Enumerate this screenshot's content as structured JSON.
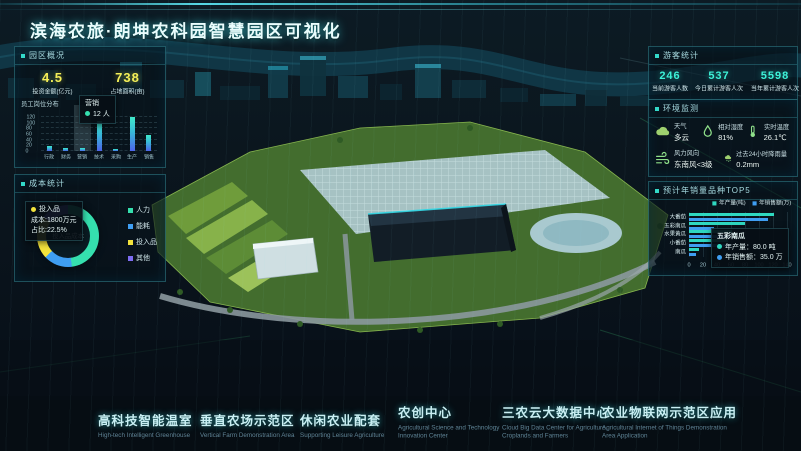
{
  "title": "滨海农旅·朗坤农科园智慧园区可视化",
  "panels": {
    "overview": {
      "header": "园区概况",
      "stats": [
        {
          "value": "4.5",
          "label": "投资金额(亿元)"
        },
        {
          "value": "738",
          "label": "占地面积(亩)"
        }
      ],
      "staff_title": "员工岗位分布",
      "tooltip": {
        "category": "营销",
        "value": "12",
        "unit": "人"
      }
    },
    "cost": {
      "header": "成本统计",
      "center_label": "投入品成本",
      "tooltip": {
        "name": "投入品",
        "line1": "成本:1800万元",
        "line2": "占比:22.5%"
      },
      "legend": [
        {
          "label": "人力",
          "color": "#35dfae"
        },
        {
          "label": "能耗",
          "color": "#3f9ef2"
        },
        {
          "label": "投入品",
          "color": "#f2e23c"
        },
        {
          "label": "其他",
          "color": "#7d6cf2"
        }
      ]
    },
    "visitors": {
      "header": "游客统计",
      "stats": [
        {
          "value": "246",
          "label": "当前游客人数"
        },
        {
          "value": "537",
          "label": "今日累计游客人次"
        },
        {
          "value": "5598",
          "label": "当年累计游客人次"
        }
      ]
    },
    "environment": {
      "header": "环境监测",
      "items": [
        {
          "icon": "cloud-icon",
          "label": "天气",
          "value": "多云"
        },
        {
          "icon": "droplet-icon",
          "label": "相对湿度",
          "value": "81%"
        },
        {
          "icon": "thermometer-icon",
          "label": "实时温度",
          "value": "26.1℃"
        },
        {
          "icon": "wind-icon",
          "label": "风力风向",
          "value": "东南风<3级"
        },
        {
          "icon": "rain-icon",
          "label": "过去24小时降雨量",
          "value": "0.2mm"
        }
      ]
    },
    "sales": {
      "header": "预计年销量品种TOP5",
      "tooltip": {
        "name": "五彩南瓜",
        "line1": "年产量：80.0 吨",
        "line2": "年销售额：35.0 万"
      }
    }
  },
  "bottom_nav": [
    {
      "zh": "高科技智能温室",
      "en": "High-tech Intelligent Greenhouse"
    },
    {
      "zh": "垂直农场示范区",
      "en": "Vertical Farm Demonstration Area"
    },
    {
      "zh": "休闲农业配套",
      "en": "Supporting Leisure Agriculture"
    },
    {
      "zh": "农创中心",
      "en": "Agricultural Science and Technology Innovation Center"
    },
    {
      "zh": "三农云大数据中心",
      "en": "Cloud Big Data Center for Agriculture, Croplands and Farmers"
    },
    {
      "zh": "农业物联网示范区应用",
      "en": "Agricultural Internet of Things Demonstration Area Application"
    }
  ],
  "colors": {
    "accent": "#2fd9c8",
    "yellow": "#f3ef58",
    "teal_value": "#3df2d8",
    "bar_production": "#2fd8c0",
    "bar_sales": "#3f9ef2"
  },
  "chart_data": [
    {
      "id": "staff",
      "type": "bar",
      "title": "员工岗位分布",
      "categories": [
        "行政",
        "财务",
        "营销",
        "技术",
        "采购",
        "生产",
        "销售"
      ],
      "values": [
        18,
        10,
        12,
        105,
        8,
        120,
        55
      ],
      "ylabel": "人数",
      "ylim": [
        0,
        120
      ],
      "yticks": [
        0,
        20,
        40,
        60,
        80,
        100,
        120
      ],
      "highlight_index": 2,
      "tooltip": {
        "category": "营销",
        "value": 12,
        "unit": "人"
      }
    },
    {
      "id": "cost",
      "type": "pie",
      "title": "成本统计",
      "center_label": "投入品成本",
      "segments": [
        {
          "label": "人力",
          "value": 48,
          "color": "#35dfae"
        },
        {
          "label": "能耗",
          "value": 15,
          "color": "#3f9ef2"
        },
        {
          "label": "投入品",
          "value": 22.5,
          "color": "#f2e23c"
        },
        {
          "label": "其他",
          "value": 14.5,
          "color": "#7d6cf2"
        }
      ],
      "tooltip": {
        "label": "投入品",
        "cost": "1800万元",
        "share": "22.5%"
      }
    },
    {
      "id": "sales",
      "type": "bar",
      "orientation": "horizontal",
      "title": "预计年销量品种TOP5",
      "categories": [
        "大番茄",
        "五彩南瓜",
        "水果黄瓜",
        "小番茄",
        "南瓜"
      ],
      "series": [
        {
          "name": "年产量(吨)",
          "color": "#2fd8c0",
          "values": [
            121,
            80,
            62,
            55,
            14
          ]
        },
        {
          "name": "年销售额(万)",
          "color": "#3f9ef2",
          "values": [
            113,
            35,
            58,
            60,
            10
          ]
        }
      ],
      "xlim": [
        0,
        140
      ],
      "xticks": [
        0,
        20,
        40,
        60,
        80,
        100,
        120,
        140
      ],
      "tooltip": {
        "category": "五彩南瓜",
        "production": "80.0 吨",
        "revenue": "35.0 万"
      }
    }
  ]
}
